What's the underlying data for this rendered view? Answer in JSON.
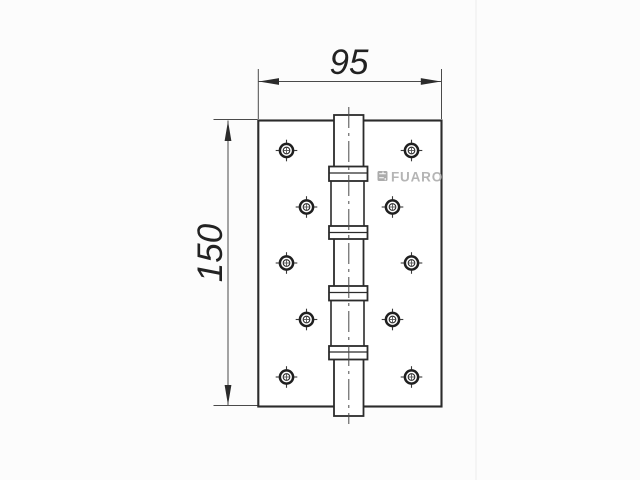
{
  "drawing": {
    "dimension_width_mm": "95",
    "dimension_height_mm": "150",
    "brand_logo": "FUARO",
    "colors": {
      "background": "#fcfcfc",
      "outline": "#2b2b2b",
      "dimension_line": "#4a4a4a",
      "logo_gray": "#b5b5b5"
    }
  }
}
